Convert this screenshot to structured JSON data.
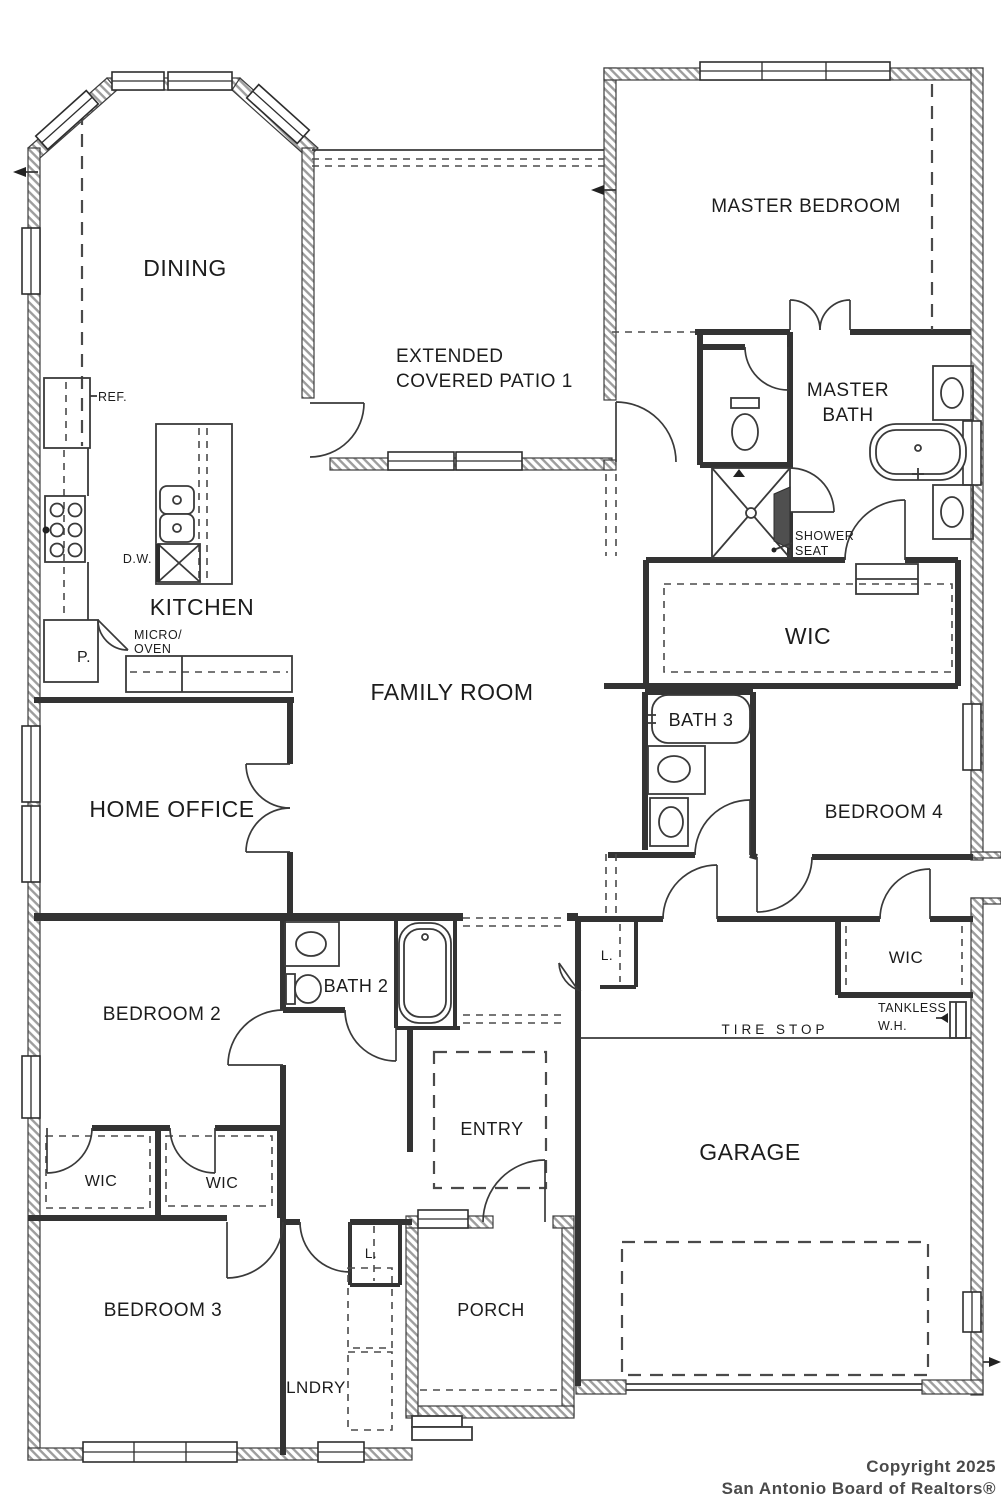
{
  "title": "Residential floor plan",
  "colors": {
    "walls": "#3c3c3c",
    "hatch": "#9d9d9d",
    "lines": "#3a3a3a",
    "text": "#1c1c1c",
    "footer_text": "#4a4a4a",
    "background": "#ffffff"
  },
  "labels": {
    "dining": "DINING",
    "patio_line1": "EXTENDED",
    "patio_line2": "COVERED PATIO 1",
    "master_bedroom": "MASTER BEDROOM",
    "master_bath_line1": "MASTER",
    "master_bath_line2": "BATH",
    "ref": "REF.",
    "dw": "D.W.",
    "kitchen": "KITCHEN",
    "micro_line1": "MICRO/",
    "micro_line2": "OVEN",
    "pantry": "P.",
    "family_room": "FAMILY ROOM",
    "shower_seat_line1": "SHOWER",
    "shower_seat_line2": "SEAT",
    "wic_master": "WIC",
    "bath3": "BATH 3",
    "bedroom4": "BEDROOM 4",
    "home_office": "HOME OFFICE",
    "wic_bedroom4": "WIC",
    "tankless_line1": "TANKLESS",
    "tankless_line2": "W.H.",
    "tire_stop": "TIRE STOP",
    "bedroom2": "BEDROOM 2",
    "bath2": "BATH 2",
    "wic_left": "WIC",
    "wic_right": "WIC",
    "entry": "ENTRY",
    "garage": "GARAGE",
    "bedroom3": "BEDROOM 3",
    "laundry": "LNDRY",
    "linen_hall": "L.",
    "linen_laundry": "L.",
    "porch": "PORCH"
  },
  "footer": {
    "line1": "Copyright 2025",
    "line2": "San Antonio Board of Realtors®"
  }
}
